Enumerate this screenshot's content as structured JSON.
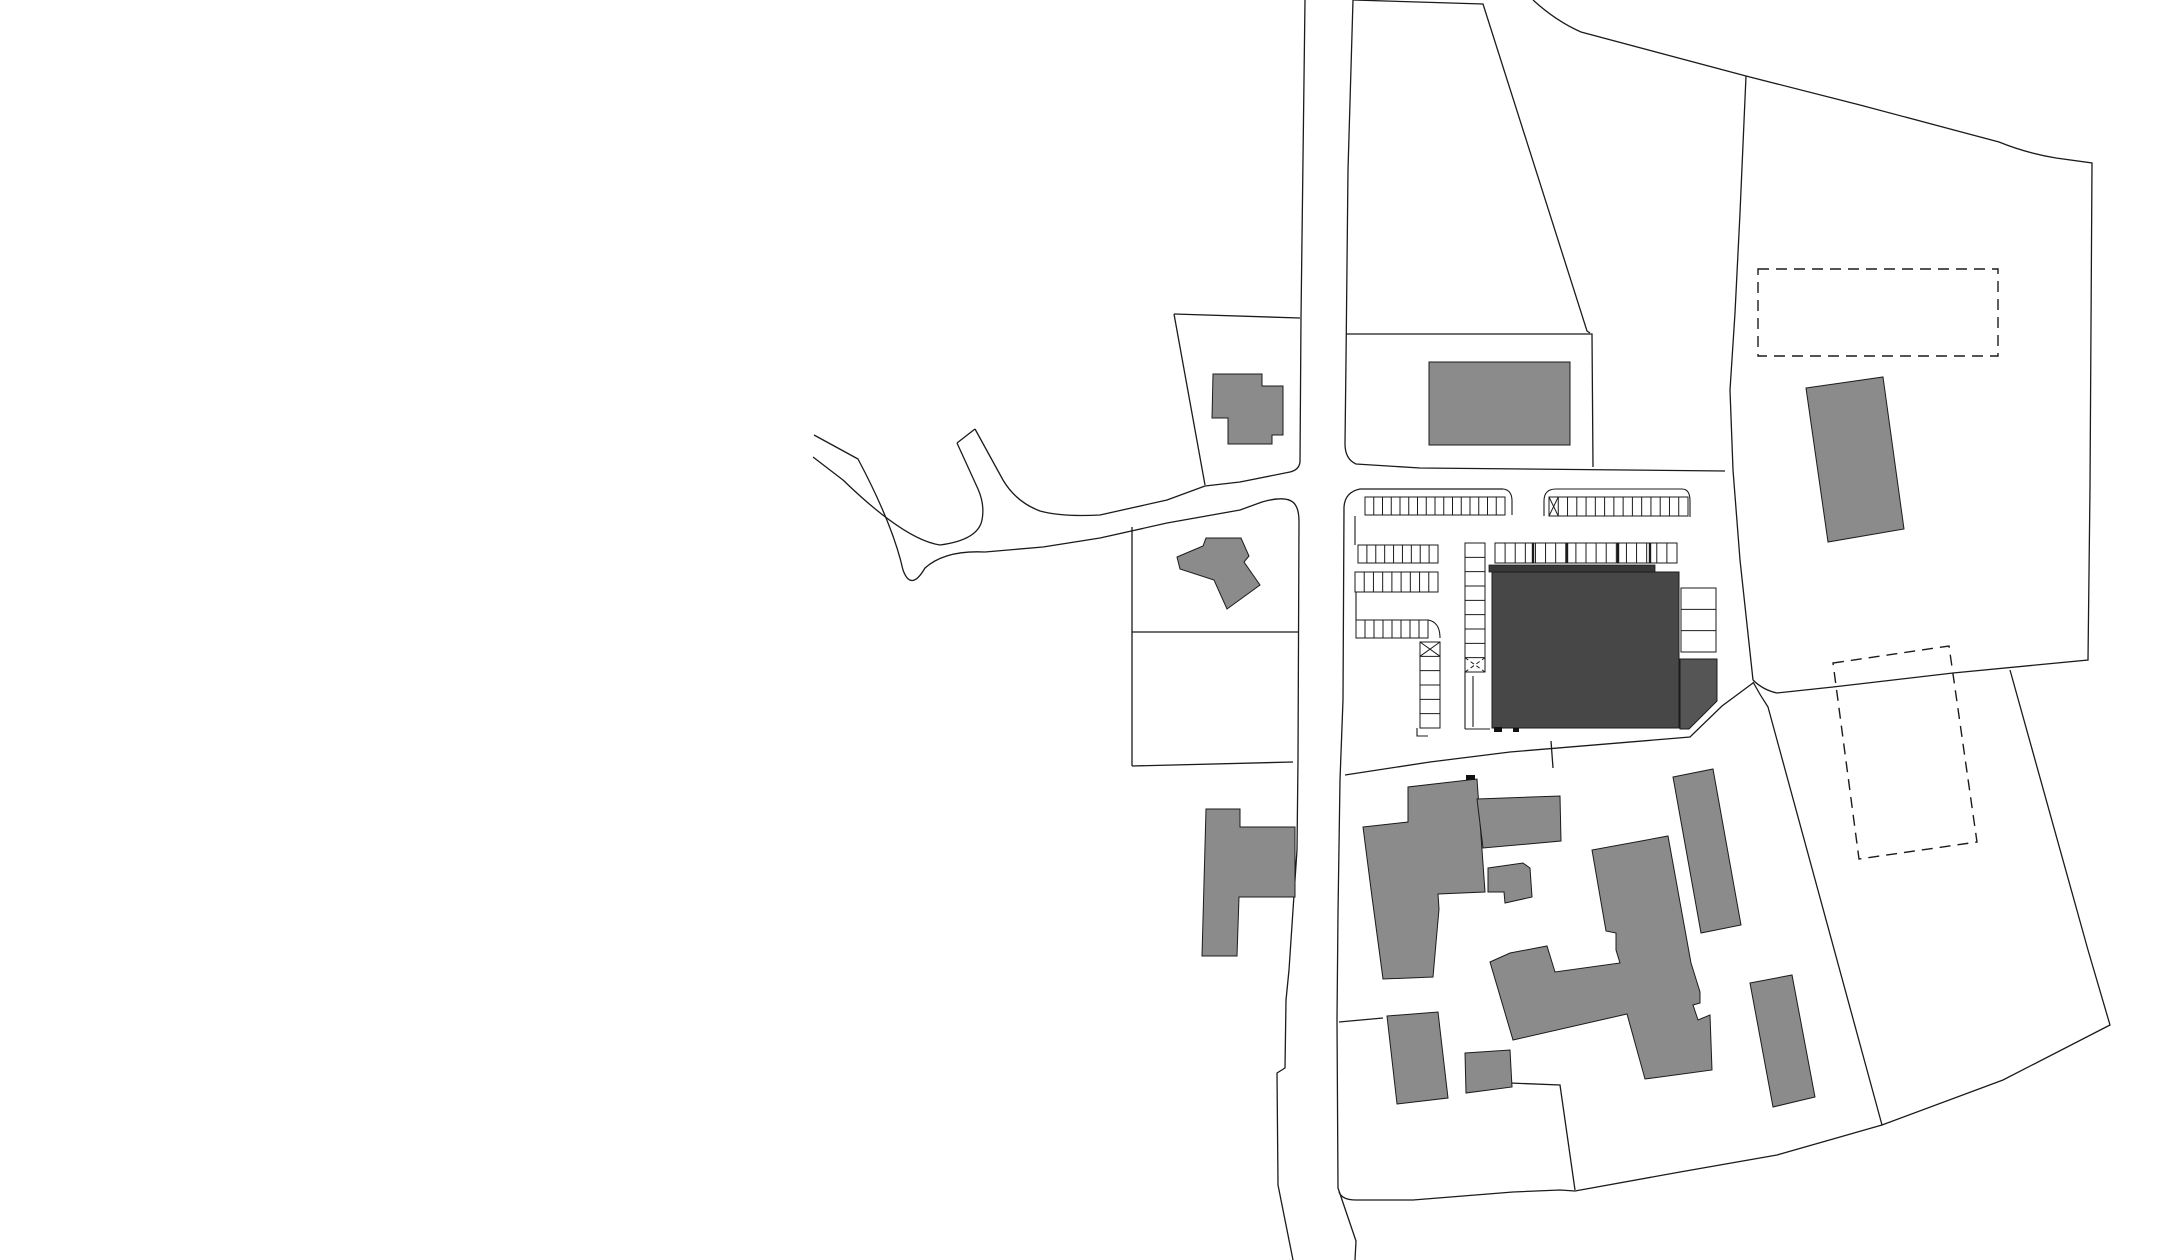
{
  "document": {
    "kind": "architectural-site-plan",
    "canvas": {
      "width": 2182,
      "height": 1260,
      "background": "#ffffff"
    }
  },
  "colors": {
    "line": "#1b1b1b",
    "existing_building": "#8b8b8b",
    "project_building_body": "#474747",
    "project_building_roofband": "#383838",
    "project_building_annex": "#555555",
    "entrance_mark": "#101010",
    "background": "#ffffff"
  },
  "site": {
    "parcel_lines": [
      {
        "name": "parcel-trapezoid-north",
        "d": "M1353,0 L1483,4 L1587,331 L1590,333"
      },
      {
        "name": "boundary-north",
        "d": "M1533,0 Q1556,21 1581,32 L1746,76 L1860,105 L1999,142 Q2026,153 2056,158 L2092,163 L2090,487 L2088,660 L1953,673 L1833,687 L1777,693"
      },
      {
        "name": "boundary-west-longline",
        "d": "M1746,76 L1740,213 L1735,313 L1730,390 L1733,470 L1740,560 L1753,680"
      },
      {
        "name": "boundary-node-east",
        "d": "M1753,680 Q1763,690 1777,693"
      },
      {
        "name": "boundary-southwest-line",
        "d": "M1753,682 Q1760,695 1768,707 L1777,740 L1882,1125"
      },
      {
        "name": "boundary-south-loop",
        "d": "M1339,1192 Q1342,1200 1356,1200 L1413,1200 L1513,1192 L1560,1190 L1575,1191 L1680,1172 L1777,1155 L1882,1125 L2003,1080 L2110,1025 L2088,950 L2010,670"
      },
      {
        "name": "parcel-spur-south",
        "d": "M1575,1190 L1560,1085 L1510,1083"
      },
      {
        "name": "parcel-diagonal-below-parking",
        "d": "M1345,775 L1430,762 L1510,752 L1690,737 L1722,706 L1753,683"
      },
      {
        "name": "parcel-spur-mid",
        "d": "M1551,741 L1553,768"
      },
      {
        "name": "parcel-north-rect",
        "d": "M1346,334 L1592,334 L1593,467"
      },
      {
        "name": "parcel-northwest-top",
        "d": "M1174,314 L1300,318"
      },
      {
        "name": "parcel-northwest-west",
        "d": "M1174,314 L1205,485"
      },
      {
        "name": "parcel-mid-west-vertical",
        "d": "M1132,527 L1132,766"
      },
      {
        "name": "parcel-mid-horizontal",
        "d": "M1132,632 L1298,632"
      },
      {
        "name": "parcel-mid-bottom",
        "d": "M1132,766 L1293,762"
      },
      {
        "name": "parcel-south-inner",
        "d": "M1339,1022 L1383,1018"
      }
    ],
    "road_lines": [
      {
        "name": "road-west-edge-and-branch-north",
        "d": "M1305,0 L1301,318 L1300,462 Q1299,470 1290,472 Q1270,476 1240,482 L1205,486 L1167,500 L1100,515 Q1062,517 1040,511 Q1016,502 1003,480 L975,429"
      },
      {
        "name": "road-stub-endcap",
        "d": "M975,429 L957,443"
      },
      {
        "name": "road-branch-inner-edge",
        "d": "M957,443 L978,489 Q985,505 982,520 Q978,540 940,545 Q905,540 843,480 L813,457"
      },
      {
        "name": "road-outer-edge-full",
        "d": "M814,435 L858,459 Q893,525 903,570 Q911,592 925,568 Q945,550 985,552 L1043,547 L1100,538 L1167,523 L1240,510 L1262,502 Q1290,494 1296,506 Q1299,511 1299,522 L1298,760 L1297,850 L1289,970 L1286,1000 L1285,1068 L1277,1073 L1278,1185 L1293,1260"
      },
      {
        "name": "road-east-edge-north",
        "d": "M1353,0 L1348,170 L1346,360 L1345,444 Q1345,459 1356,464 L1420,468 L1725,471"
      },
      {
        "name": "road-east-edge-south",
        "d": "M1503,489 L1360,489 Q1345,492 1344,507 L1343,700 L1340,780 L1338,913 L1337,1020 L1338,1188 L1356,1241 L1355,1260"
      }
    ],
    "parking": {
      "outlines": [
        {
          "name": "parking-lot1-right-corner",
          "d": "M1503,489 Q1512,490 1512,501 L1512,515"
        },
        {
          "name": "parking-lot2-outline",
          "d": "M1544,516 L1544,501 Q1544,489 1556,489 L1682,489 Q1690,489 1690,501 L1690,517"
        },
        {
          "name": "parking-lot1-inner-edge",
          "d": "M1355,516 L1355,545 M1356,592 L1356,620"
        },
        {
          "name": "parking-corridor",
          "d": "M1465,672 L1465,729 M1473,676 L1473,727 M1465,729 L1490,729"
        },
        {
          "name": "parking-col-west-foot",
          "d": "M1417,728 L1417,736 L1428,736"
        },
        {
          "name": "parking-row4-corner",
          "d": "M1428,620 Q1440,622 1440,638"
        }
      ],
      "strips": [
        {
          "name": "stall-row-northwest",
          "x1": 1365,
          "y1": 497,
          "x2": 1505,
          "y2": 515,
          "orient": "h",
          "stalls": 16
        },
        {
          "name": "stall-row-northeast",
          "x1": 1549,
          "y1": 497,
          "x2": 1688,
          "y2": 516,
          "orient": "h",
          "stalls": 15,
          "xcell": {
            "index": 0,
            "dashed": false
          }
        },
        {
          "name": "stall-row-west-2",
          "x1": 1358,
          "y1": 545,
          "x2": 1438,
          "y2": 563,
          "orient": "h",
          "stalls": 9
        },
        {
          "name": "stall-row-west-3",
          "x1": 1355,
          "y1": 572,
          "x2": 1438,
          "y2": 592,
          "orient": "h",
          "stalls": 9
        },
        {
          "name": "stall-row-west-4",
          "x1": 1356,
          "y1": 620,
          "x2": 1428,
          "y2": 638,
          "orient": "h",
          "stalls": 8
        },
        {
          "name": "stall-col-west",
          "x1": 1420,
          "y1": 642,
          "x2": 1440,
          "y2": 728,
          "orient": "v",
          "stalls": 6,
          "xcell": {
            "index": 0,
            "dashed": false
          }
        },
        {
          "name": "stall-col-middle",
          "x1": 1465,
          "y1": 543,
          "x2": 1485,
          "y2": 672,
          "orient": "v",
          "stalls": 9,
          "xcell": {
            "index": 8,
            "dashed": true
          }
        },
        {
          "name": "stall-row-at-building",
          "x1": 1495,
          "y1": 543,
          "x2": 1677,
          "y2": 563,
          "orient": "h",
          "stalls": 18,
          "thick_dividers_x": [
            1533,
            1567,
            1618,
            1650
          ]
        },
        {
          "name": "stall-col-east-of-building",
          "x1": 1681,
          "y1": 588,
          "x2": 1716,
          "y2": 652,
          "orient": "v",
          "stalls": 3
        }
      ]
    },
    "buildings_existing": [
      {
        "name": "existing-building-north-small",
        "points": [
          [
            1213,
            374
          ],
          [
            1262,
            374
          ],
          [
            1262,
            386
          ],
          [
            1283,
            386
          ],
          [
            1283,
            435
          ],
          [
            1272,
            435
          ],
          [
            1272,
            444
          ],
          [
            1228,
            444
          ],
          [
            1228,
            418
          ],
          [
            1212,
            418
          ]
        ]
      },
      {
        "name": "existing-building-west-rotated",
        "points": [
          [
            1177,
            557
          ],
          [
            1203,
            546
          ],
          [
            1206,
            538
          ],
          [
            1241,
            538
          ],
          [
            1249,
            556
          ],
          [
            1244,
            562
          ],
          [
            1260,
            585
          ],
          [
            1227,
            609
          ],
          [
            1214,
            580
          ],
          [
            1180,
            569
          ]
        ]
      },
      {
        "name": "existing-building-north-rect",
        "points": [
          [
            1429,
            362
          ],
          [
            1570,
            362
          ],
          [
            1570,
            445
          ],
          [
            1429,
            445
          ]
        ]
      },
      {
        "name": "existing-building-northeast-slanted",
        "points": [
          [
            1806,
            388
          ],
          [
            1883,
            377
          ],
          [
            1904,
            529
          ],
          [
            1828,
            542
          ]
        ]
      },
      {
        "name": "existing-building-west-tshape",
        "points": [
          [
            1206,
            809
          ],
          [
            1240,
            809
          ],
          [
            1240,
            827
          ],
          [
            1295,
            827
          ],
          [
            1295,
            897
          ],
          [
            1239,
            897
          ],
          [
            1237,
            956
          ],
          [
            1202,
            956
          ]
        ]
      },
      {
        "name": "existing-building-cluster-a",
        "points": [
          [
            1363,
            827
          ],
          [
            1408,
            822
          ],
          [
            1408,
            787
          ],
          [
            1477,
            779
          ],
          [
            1485,
            892
          ],
          [
            1438,
            894
          ],
          [
            1439,
            909
          ],
          [
            1433,
            977
          ],
          [
            1383,
            979
          ],
          [
            1372,
            897
          ]
        ]
      },
      {
        "name": "existing-building-cluster-wing",
        "points": [
          [
            1477,
            799
          ],
          [
            1560,
            796
          ],
          [
            1561,
            841
          ],
          [
            1483,
            848
          ]
        ]
      },
      {
        "name": "existing-building-cluster-square",
        "points": [
          [
            1488,
            868
          ],
          [
            1523,
            863
          ],
          [
            1530,
            868
          ],
          [
            1532,
            897
          ],
          [
            1505,
            903
          ],
          [
            1504,
            892
          ],
          [
            1488,
            892
          ]
        ]
      },
      {
        "name": "existing-building-tall-east",
        "points": [
          [
            1673,
            777
          ],
          [
            1713,
            769
          ],
          [
            1741,
            925
          ],
          [
            1701,
            933
          ]
        ]
      },
      {
        "name": "existing-building-cross",
        "points": [
          [
            1490,
            962
          ],
          [
            1510,
            953
          ],
          [
            1547,
            946
          ],
          [
            1555,
            972
          ],
          [
            1620,
            963
          ],
          [
            1616,
            950
          ],
          [
            1616,
            933
          ],
          [
            1606,
            931
          ],
          [
            1592,
            850
          ],
          [
            1668,
            836
          ],
          [
            1691,
            963
          ],
          [
            1700,
            992
          ],
          [
            1700,
            1003
          ],
          [
            1693,
            1005
          ],
          [
            1698,
            1020
          ],
          [
            1710,
            1015
          ],
          [
            1712,
            1070
          ],
          [
            1645,
            1079
          ],
          [
            1627,
            1014
          ],
          [
            1513,
            1040
          ]
        ]
      },
      {
        "name": "existing-building-south-1",
        "points": [
          [
            1387,
            1016
          ],
          [
            1438,
            1012
          ],
          [
            1448,
            1098
          ],
          [
            1397,
            1104
          ]
        ]
      },
      {
        "name": "existing-building-south-2",
        "points": [
          [
            1465,
            1053
          ],
          [
            1510,
            1050
          ],
          [
            1512,
            1087
          ],
          [
            1466,
            1093
          ]
        ]
      },
      {
        "name": "existing-building-south-3",
        "points": [
          [
            1750,
            983
          ],
          [
            1792,
            975
          ],
          [
            1815,
            1097
          ],
          [
            1773,
            1107
          ]
        ]
      }
    ],
    "project_building": {
      "body": {
        "name": "project-building-body",
        "points": [
          [
            1492,
            572
          ],
          [
            1679,
            572
          ],
          [
            1679,
            728
          ],
          [
            1492,
            728
          ]
        ]
      },
      "roofband": {
        "name": "project-building-roofband",
        "points": [
          [
            1489,
            565
          ],
          [
            1655,
            565
          ],
          [
            1655,
            572
          ],
          [
            1489,
            572
          ]
        ]
      },
      "annex": {
        "name": "project-building-annex",
        "points": [
          [
            1680,
            659
          ],
          [
            1717,
            659
          ],
          [
            1717,
            701
          ],
          [
            1689,
            729
          ],
          [
            1680,
            729
          ]
        ]
      },
      "entrance_marks": [
        {
          "name": "entrance-mark-1",
          "x": 1494,
          "y": 727,
          "w": 8,
          "h": 5
        },
        {
          "name": "entrance-mark-2",
          "x": 1513,
          "y": 728,
          "w": 6,
          "h": 4
        },
        {
          "name": "entrance-mark-3",
          "x": 1466,
          "y": 775,
          "w": 9,
          "h": 5
        }
      ]
    },
    "dashed_outlines": [
      {
        "name": "planned-outline-north",
        "points": [
          [
            1758,
            269
          ],
          [
            1998,
            269
          ],
          [
            1998,
            356
          ],
          [
            1758,
            356
          ]
        ]
      },
      {
        "name": "planned-outline-east",
        "points": [
          [
            1833,
            663
          ],
          [
            1949,
            646
          ],
          [
            1977,
            842
          ],
          [
            1859,
            859
          ]
        ]
      }
    ]
  }
}
